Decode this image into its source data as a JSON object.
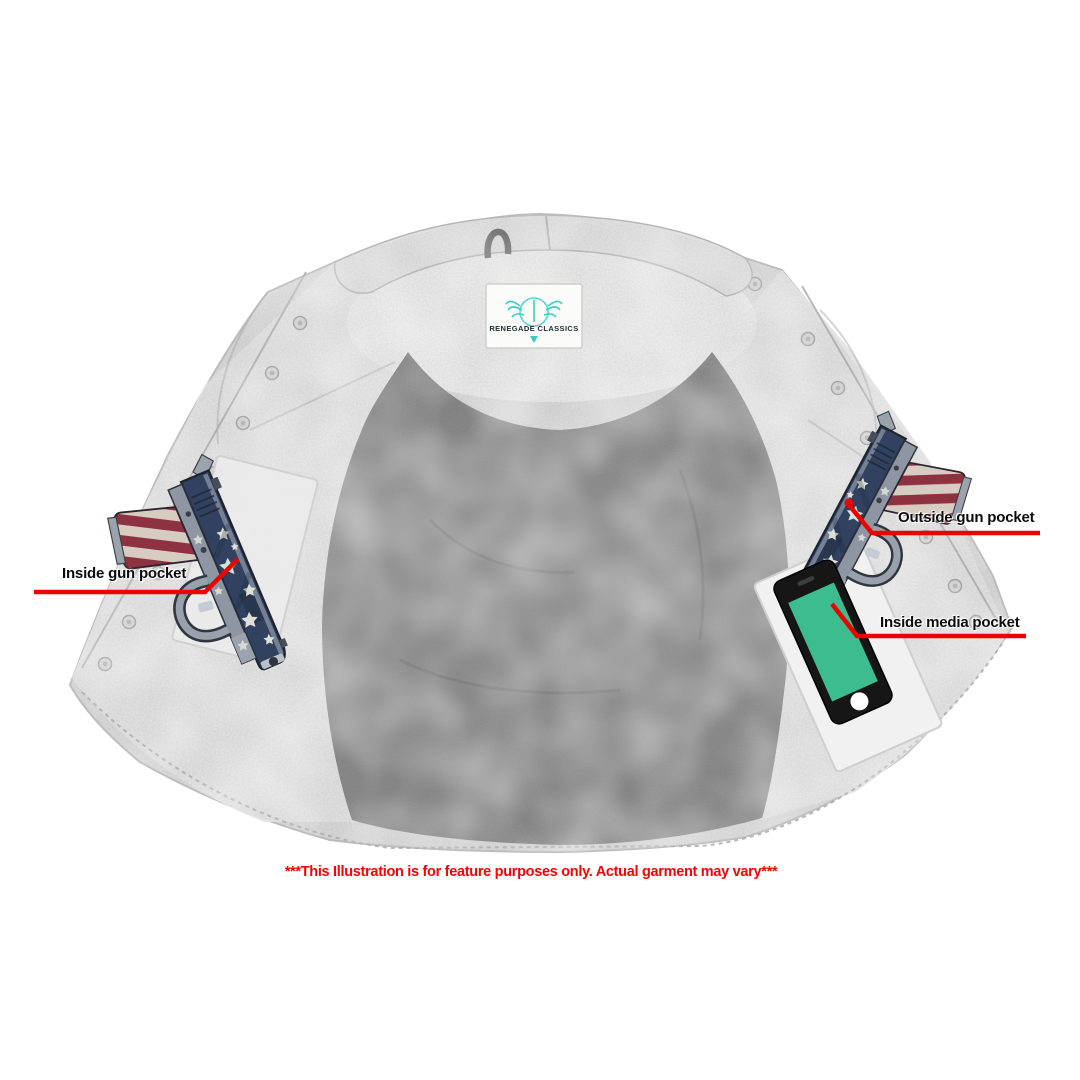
{
  "page": {
    "width": 1080,
    "height": 1080,
    "background": "#ffffff"
  },
  "product_illustration": {
    "brand_label": {
      "text": "RENEGADE CLASSICS"
    },
    "callouts": [
      {
        "label": "Inside gun pocket"
      },
      {
        "label": "Outside gun pocket"
      },
      {
        "label": "Inside media pocket"
      }
    ],
    "disclaimer": "***This Illustration is for feature purposes only. Actual garment may vary***",
    "colors": {
      "callout_line": "#ee0000",
      "callout_text": "#0c0c0c",
      "disclaimer_text": "#ff0000",
      "phone_screen": "#3dbd8f",
      "logo_teal": "#3acfc4",
      "vest_fabric": "#d9d9d9",
      "vest_lining": "#8a8a8a",
      "flag_blue": "#31415f",
      "flag_red": "#8e3140"
    }
  }
}
